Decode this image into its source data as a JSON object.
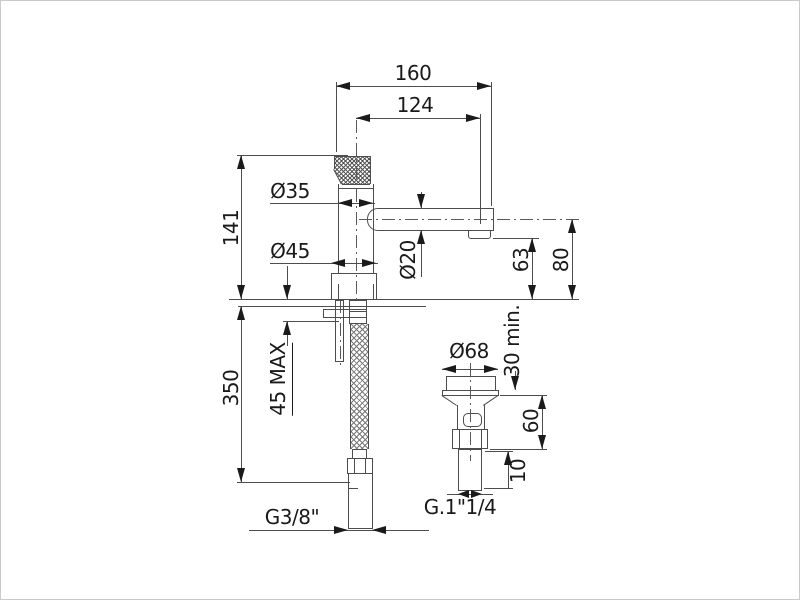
{
  "page": {
    "background": "#ffffff",
    "border_color": "#c9c9c9",
    "line_color": "#4d4d4d",
    "text_color": "#1a1a1a",
    "description": "Technical dimension drawing of a single-lever basin faucet with flexible supply hose and pop-up waste"
  },
  "labels": {
    "dim_160": "160",
    "dim_124": "124",
    "dim_141": "141",
    "dia_35": "Ø35",
    "dia_45": "Ø45",
    "dia_20": "Ø20",
    "dim_63": "63",
    "dim_80": "80",
    "dim_350": "350",
    "dim_45max": "45 MAX",
    "thread_inlet": "G3/8\"",
    "dia_68": "Ø68",
    "dim_30min": "30 min.",
    "dim_60": "60",
    "dim_10": "10",
    "thread_waste": "G.1\"1/4"
  }
}
